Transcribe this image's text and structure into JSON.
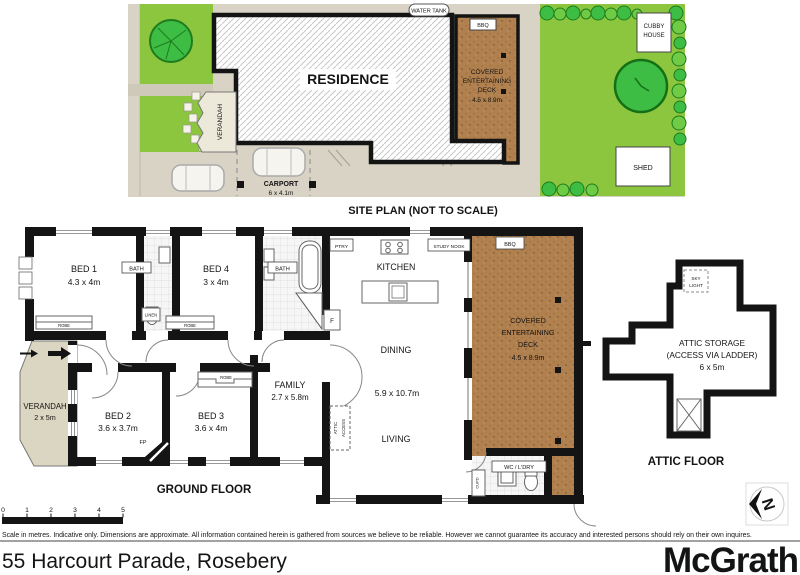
{
  "site_plan": {
    "title": "SITE PLAN (NOT TO SCALE)",
    "residence": "RESIDENCE",
    "verandah": "VERANDAH",
    "water_tank": "WATER TANK",
    "bbq": "BBQ",
    "deck": {
      "l1": "COVERED",
      "l2": "ENTERTAINING",
      "l3": "DECK",
      "dims": "4.5 x 8.9m"
    },
    "carport": {
      "name": "CARPORT",
      "dims": "6 x 4.1m"
    },
    "cubby": {
      "l1": "CUBBY",
      "l2": "HOUSE"
    },
    "shed": "SHED"
  },
  "ground_floor": {
    "title": "GROUND FLOOR",
    "bed1": {
      "name": "BED 1",
      "dims": "4.3 x 4m"
    },
    "bed2": {
      "name": "BED 2",
      "dims": "3.6 x 3.7m"
    },
    "bed3": {
      "name": "BED 3",
      "dims": "3.6 x 4m"
    },
    "bed4": {
      "name": "BED 4",
      "dims": "3 x 4m"
    },
    "bath": "BATH",
    "kitchen": "KITCHEN",
    "dining": "DINING",
    "living": "LIVING",
    "open_plan_dims": "5.9 x 10.7m",
    "family": {
      "name": "FAMILY",
      "dims": "2.7 x 5.8m"
    },
    "verandah": {
      "name": "VERANDAH",
      "dims": "2 x 5m"
    },
    "deck": {
      "l1": "COVERED",
      "l2": "ENTERTAINING",
      "l3": "DECK",
      "dims": "4.5 x 8.9m"
    },
    "wc_ldry": "WC / L'DRY",
    "robe": "ROBE",
    "linen": "LINEN",
    "ptry": "PTRY",
    "study_nook": "STUDY NOOK",
    "bbq": "BBQ",
    "fp": "FP",
    "fridge": "F",
    "cupd": "CUPD",
    "attic_access": {
      "l1": "ATTIC",
      "l2": "ACCESS"
    }
  },
  "attic": {
    "title": "ATTIC FLOOR",
    "storage_l1": "ATTIC STORAGE",
    "storage_l2": "(ACCESS VIA LADDER)",
    "storage_l3": "6 x 5m",
    "skylight": {
      "l1": "SKY",
      "l2": "LIGHT"
    }
  },
  "scale_bar": {
    "ticks": [
      "0",
      "1",
      "2",
      "3",
      "4",
      "5"
    ]
  },
  "footer": {
    "disclaimer": "Scale in metres. Indicative only. Dimensions are approximate. All information contained herein is gathered from sources we believe to be reliable. However we cannot guarantee its accuracy and interested persons should rely on their own inquires.",
    "address": "55 Harcourt Parade, Rosebery",
    "brand": "McGrath",
    "compass": "N"
  },
  "colors": {
    "grass": "#8cc63f",
    "tree": "#3ebd44",
    "deck": "#b1804f",
    "paving": "#d8d3c5",
    "verandah": "#dbd6c1",
    "wall": "#141414"
  }
}
